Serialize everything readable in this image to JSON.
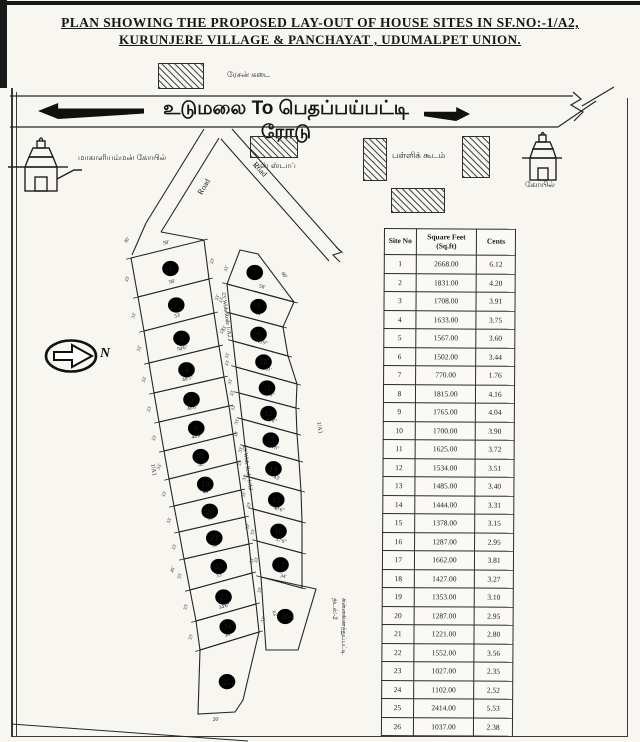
{
  "title": {
    "line1": "PLAN SHOWING THE PROPOSED LAY-OUT OF HOUSE SITES IN SF.NO:-1/A2,",
    "line2": "KURUNJERE VILLAGE & PANCHAYAT , UDUMALPET UNION."
  },
  "banner": {
    "text": "உடுமலை To பெதப்பய்பட்டி ரோடு"
  },
  "landmarks": {
    "ration_shop": "ரேசன் கடை",
    "bus_stop": "பஸ் ஸ்டாப்",
    "school": "பள்ளிக் கூடம்",
    "temple_left": "மாகாளியம்மன் கோயில்",
    "temple_right": "கோயில்",
    "north": "N"
  },
  "map": {
    "road_label": "Road",
    "internal_road_label": "23' Wide Rode  1/A2",
    "adjacent_survey_label": "1/A1",
    "corner_dim": "36'",
    "depth_dim": "33'",
    "bottom_dim": "20'",
    "plot22_side_dim": "45'",
    "plot26_side_dims": [
      "63'",
      "75'"
    ],
    "south_label_lines": [
      "திடல்:-2",
      "சின்னகிணத்துப்பட்டி"
    ],
    "left_strip": [
      {
        "no": "1",
        "dim": "58'"
      },
      {
        "no": "2",
        "dim": "58'"
      },
      {
        "no": "3",
        "dim": "53'"
      },
      {
        "no": "4",
        "dim": "50'6\""
      },
      {
        "no": "5",
        "dim": "48'5\""
      },
      {
        "no": "6",
        "dim": "46'6\""
      },
      {
        "no": "18",
        "dim": "44'6\""
      },
      {
        "no": "19",
        "dim": "42'"
      },
      {
        "no": "20",
        "dim": "40'"
      },
      {
        "no": "21",
        "dim": "38'"
      },
      {
        "no": "22",
        "dim": "36'"
      },
      {
        "no": "23",
        "dim": "33'"
      },
      {
        "no": "24",
        "dim": "34'6\""
      },
      {
        "no": "25",
        "dim": "38'"
      }
    ],
    "right_strip": [
      {
        "no": "7",
        "dim": "60'"
      },
      {
        "no": "8",
        "dim": "56'"
      },
      {
        "no": "9",
        "dim": "44'"
      },
      {
        "no": "10",
        "dim": "45'9\""
      },
      {
        "no": "11",
        "dim": "51'"
      },
      {
        "no": "12",
        "dim": "47'6\""
      },
      {
        "no": "13",
        "dim": "45'6\""
      },
      {
        "no": "14",
        "dim": "44'6\""
      },
      {
        "no": "15",
        "dim": "43'"
      },
      {
        "no": "16",
        "dim": "40'6\""
      },
      {
        "no": "17",
        "dim": "37'6\""
      },
      {
        "no": "26",
        "dim": "34'"
      }
    ]
  },
  "table": {
    "headers": [
      "Site No",
      "Square Feet",
      "Cents"
    ],
    "sub_header": "(Sq.ft)",
    "rows": [
      [
        "1",
        "2668.00",
        "6.12"
      ],
      [
        "2",
        "1831.00",
        "4.20"
      ],
      [
        "3",
        "1708.00",
        "3.91"
      ],
      [
        "4",
        "1633.00",
        "3.75"
      ],
      [
        "5",
        "1567.00",
        "3.60"
      ],
      [
        "6",
        "1502.00",
        "3.44"
      ],
      [
        "7",
        "770.00",
        "1.76"
      ],
      [
        "8",
        "1815.00",
        "4.16"
      ],
      [
        "9",
        "1765.00",
        "4.04"
      ],
      [
        "10",
        "1700.00",
        "3.90"
      ],
      [
        "11",
        "1625.00",
        "3.72"
      ],
      [
        "12",
        "1534.00",
        "3.51"
      ],
      [
        "13",
        "1485.00",
        "3.40"
      ],
      [
        "14",
        "1444.00",
        "3.31"
      ],
      [
        "15",
        "1378.00",
        "3.15"
      ],
      [
        "16",
        "1287.00",
        "2.95"
      ],
      [
        "17",
        "1662.00",
        "3.81"
      ],
      [
        "18",
        "1427.00",
        "3.27"
      ],
      [
        "19",
        "1353.00",
        "3.10"
      ],
      [
        "20",
        "1287.00",
        "2.95"
      ],
      [
        "21",
        "1221.00",
        "2.80"
      ],
      [
        "22",
        "1552.00",
        "3.56"
      ],
      [
        "23",
        "1027.00",
        "2.35"
      ],
      [
        "24",
        "1102.00",
        "2.52"
      ],
      [
        "25",
        "2414.00",
        "5.53"
      ],
      [
        "26",
        "1037.00",
        "2.38"
      ]
    ]
  }
}
